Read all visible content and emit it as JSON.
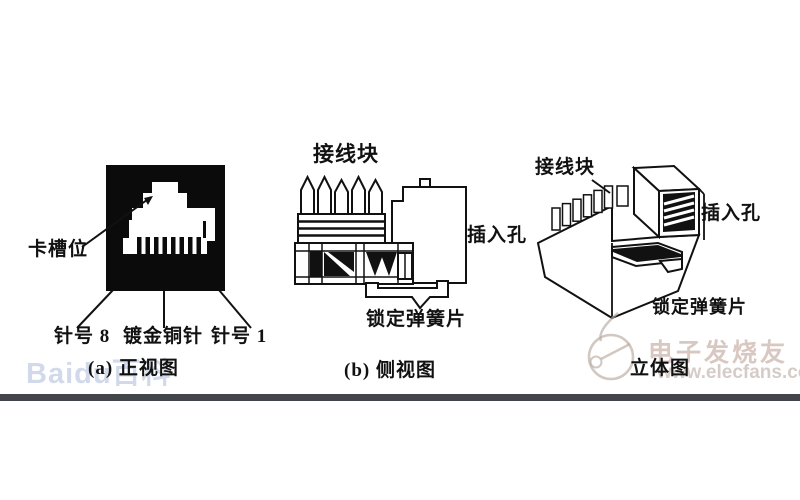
{
  "page": {
    "background": "#ffffff",
    "footer_bar_color": "#42464b",
    "ink_color": "#111111",
    "panel_color": "#0b0b0b"
  },
  "figures": [
    {
      "id": "front-view",
      "caption": "(a) 正视图",
      "labels": {
        "card_slot": "卡槽位",
        "pin8": "针号 8",
        "pins": "镀金铜针",
        "pin1": "针号 1"
      }
    },
    {
      "id": "side-view",
      "caption": "(b) 侧视图",
      "labels": {
        "block": "接线块",
        "hole": "插入孔",
        "spring": "锁定弹簧片"
      }
    },
    {
      "id": "iso-view",
      "caption": "立体图",
      "labels": {
        "block": "接线块",
        "hole": "插入孔",
        "spring": "锁定弹簧片"
      }
    }
  ],
  "watermarks": {
    "baidu": "Baidu百科",
    "elecfans_title": "电子发烧友",
    "elecfans_url": "www.elecfans.com"
  }
}
